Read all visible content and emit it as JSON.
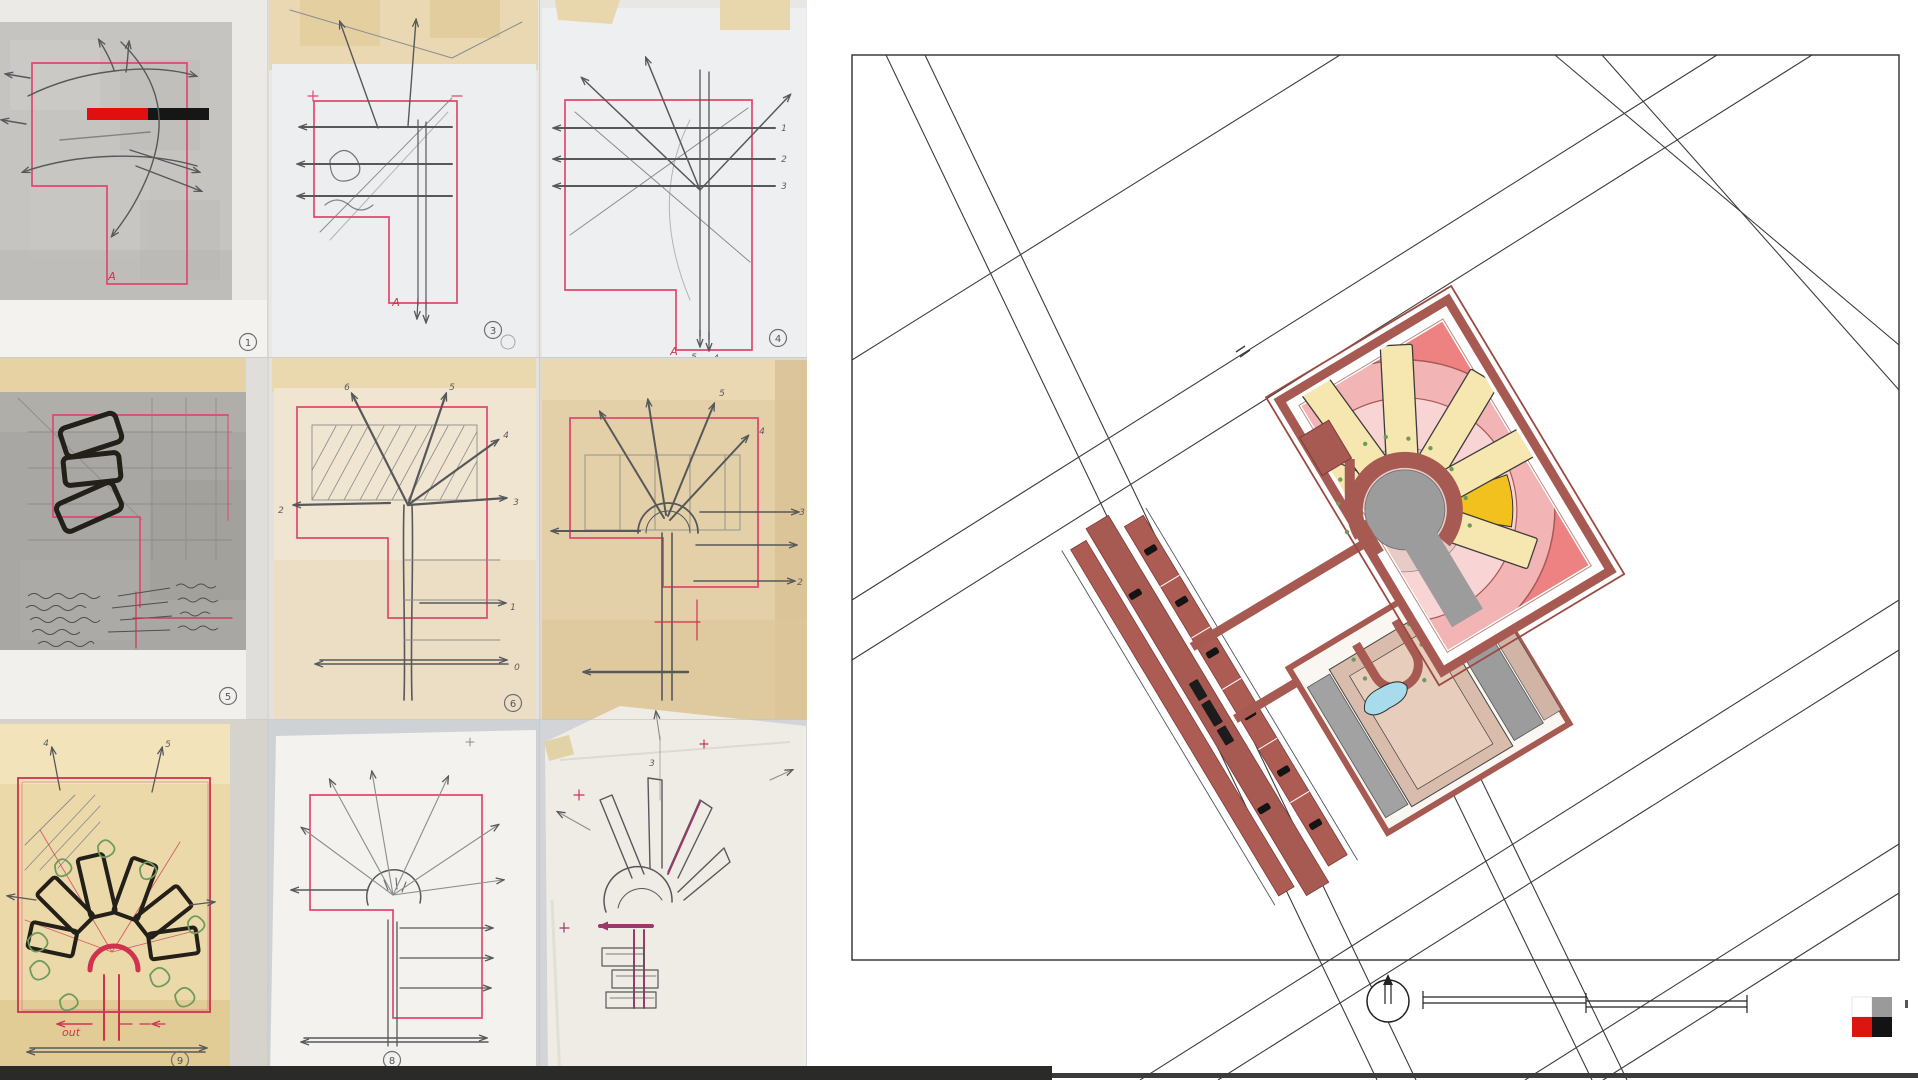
{
  "colors": {
    "pink": "#e0486e",
    "redink": "#cf3350",
    "magenta": "#993a6b",
    "pencil": "#56585a",
    "pencil_light": "#8b8d8e",
    "marker": "#232019",
    "green": "#6f9a5f",
    "band": "#a65a52",
    "band_dark": "#7e3c38",
    "band_light": "#ad5c54",
    "salmon": "#ee8282",
    "arc_mid": "#f3b4b6",
    "arc_light": "#f9d4d4",
    "arc_inner": "#e8cbc7",
    "wing": "#f6e7b0",
    "wedge": "#f2c11d",
    "gray_plaza": "#a2a2a2",
    "gray_hub": "#9c9c9c",
    "tan1": "#d9bcab",
    "tan2": "#e7cdbb",
    "pond": "#a8dcec",
    "street": "#3c3c3c",
    "paper_trace": "#eceef0",
    "paper_white": "#f2f1ed",
    "paper_tan": "#e4d0a8",
    "paper_cream": "#efe5d0",
    "photo": "#b3b1ad",
    "tape": "#e8d6ac",
    "backing": "#dededb",
    "bottombar": "#2a2a28",
    "scalebar_red": "#e01010",
    "scalebar_black": "#161616",
    "legend_red": "#dd1511",
    "legend_gray": "#9a9a9a",
    "legend_black": "#131313",
    "legend_white": "#ffffff"
  },
  "sheets": {
    "s1": {
      "num": "1",
      "mark": "A"
    },
    "s2": {
      "num": "3",
      "mark": "A"
    },
    "s3": {
      "num": "4",
      "mark": "A",
      "right": [
        "1",
        "2",
        "3"
      ],
      "down": [
        "5",
        "4"
      ]
    },
    "s4": {
      "num": "5"
    },
    "s5": {
      "num": "6",
      "fan": [
        "6",
        "5",
        "4",
        "3",
        "2",
        "1",
        "0"
      ]
    },
    "s6": {
      "fan": [
        "5",
        "4",
        "3",
        "2"
      ]
    },
    "s7": {
      "num": "9",
      "out": "out",
      "top": [
        "4",
        "5"
      ]
    },
    "s8": {
      "num": "8"
    },
    "s9": {
      "tag": "3"
    }
  }
}
